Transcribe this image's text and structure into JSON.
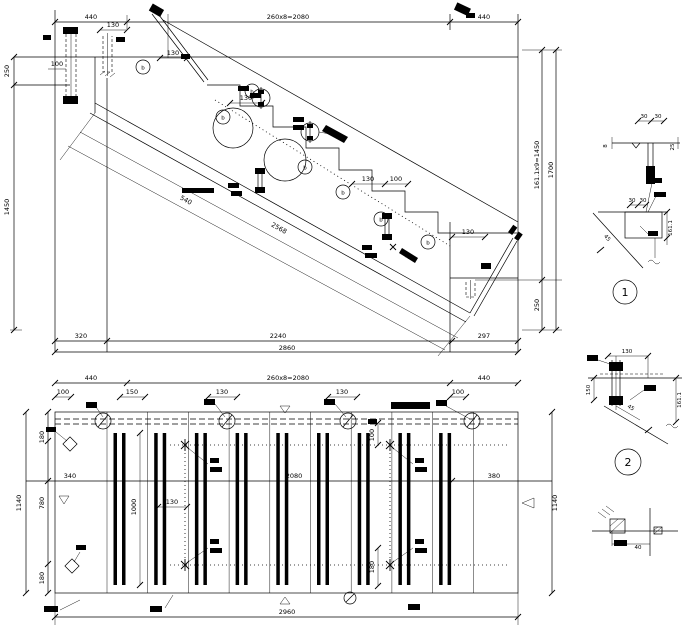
{
  "section": {
    "dim_top_left": "440",
    "dim_top_mid": "260x8=2080",
    "dim_top_right": "440",
    "dim_anchor2": "130",
    "dim_step0": "130",
    "dim_left_100": "100",
    "dim_left_250": "250",
    "dim_left_1450": "1450",
    "dim_step1": "130",
    "dim_step2": "130",
    "dim_step3": "100",
    "dim_landing": "130",
    "dim_right_risers": "161.1x9=1450",
    "dim_right_total": "1700",
    "dim_right_250": "250",
    "dim_bot_320": "320",
    "dim_bot_2240": "2240",
    "dim_bot_297": "297",
    "dim_bot_total": "2860",
    "dim_slope_540": "540",
    "dim_slope_2568": "2568",
    "dim_slope_45": "45",
    "callout_letter": "b"
  },
  "plan": {
    "dim_top_left": "440",
    "dim_top_mid": "260x8=2080",
    "dim_top_right": "440",
    "dim_100a": "100",
    "dim_150": "150",
    "dim_130a": "130",
    "dim_130b": "130",
    "dim_100b": "100",
    "dim_left_180a": "180",
    "dim_left_780": "780",
    "dim_left_180b": "180",
    "dim_left_total": "1140",
    "dim_right_total": "1140",
    "dim_mid_340": "340",
    "dim_mid_2080": "2080",
    "dim_mid_380": "380",
    "dim_tread_len": "1000",
    "dim_130c": "130",
    "dim_100c": "100",
    "dim_180c": "180",
    "dim_bottom_total": "2960"
  },
  "details": {
    "d1": {
      "label": "1",
      "dim_30a": "30",
      "dim_30b": "30",
      "dim_30c": "30",
      "dim_30d": "30",
      "dim_h": "161.1",
      "dim_8": "8",
      "dim_25": "25",
      "angle": "45"
    },
    "d2": {
      "label": "2",
      "dim_130": "130",
      "dim_150": "150",
      "dim_h": "161.1",
      "angle": "45"
    },
    "joint": {
      "dim_40": "40"
    }
  }
}
